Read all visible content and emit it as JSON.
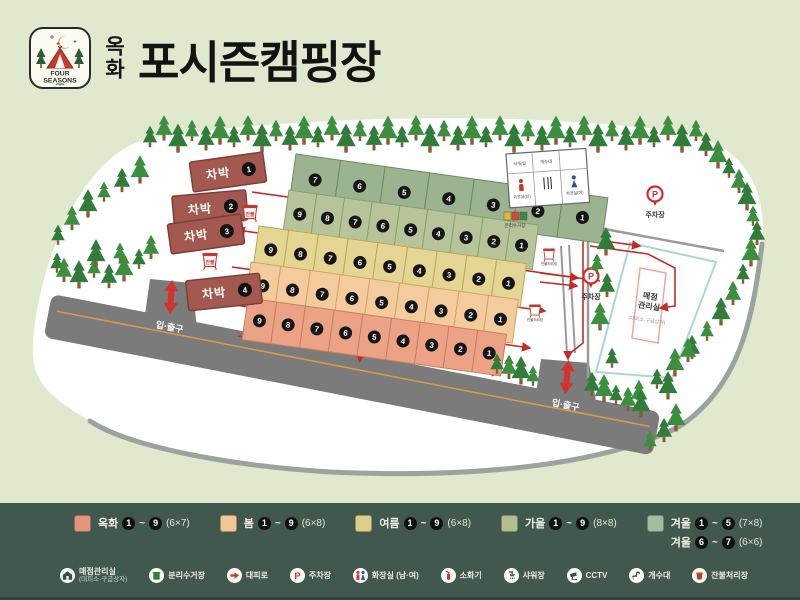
{
  "header": {
    "logo_line1": "FOUR",
    "logo_line2": "SEASONS",
    "brand_vertical": "옥화",
    "title": "포시즌캠핑장"
  },
  "map": {
    "entrance_label": "입·출구",
    "parking_label": "주차장",
    "store": {
      "name1": "매점",
      "name2": "관리실",
      "sub": "(대피소·구급상자)"
    },
    "recycle_label": "분리수거장",
    "ember_label": "잔불처리장",
    "ember_short": "잔불",
    "chabak": {
      "label": "차박",
      "sites": [
        1,
        2,
        3,
        4
      ]
    },
    "facility_rooms": [
      "샤워실",
      "개수대",
      "화장실(남)",
      "화장실(여)"
    ],
    "rows": [
      {
        "id": "winter",
        "name": "겨울",
        "numbers": [
          7,
          6,
          5,
          4,
          3,
          2,
          1
        ],
        "fill": "#9cb391",
        "stroke": "#6d8a62"
      },
      {
        "id": "autumn",
        "name": "가을",
        "numbers": [
          9,
          8,
          7,
          6,
          5,
          4,
          3,
          2,
          1
        ],
        "fill": "#b7c49a",
        "stroke": "#8ba06b"
      },
      {
        "id": "summer",
        "name": "여름",
        "numbers": [
          9,
          8,
          7,
          6,
          5,
          4,
          3,
          2,
          1
        ],
        "fill": "#e4d692",
        "stroke": "#b9a95e"
      },
      {
        "id": "spring",
        "name": "봄",
        "numbers": [
          9,
          8,
          7,
          6,
          5,
          4,
          3,
          2,
          1
        ],
        "fill": "#f4cb9d",
        "stroke": "#d2a369"
      },
      {
        "id": "okhwa",
        "name": "옥화",
        "numbers": [
          9,
          8,
          7,
          6,
          5,
          4,
          3,
          2,
          1
        ],
        "fill": "#eba285",
        "stroke": "#c97f5f"
      }
    ]
  },
  "legend": {
    "seasons": [
      {
        "name": "옥화",
        "from": "1",
        "to": "9",
        "size": "(6×7)",
        "color": "#e3957c"
      },
      {
        "name": "봄",
        "from": "1",
        "to": "9",
        "size": "(6×8)",
        "color": "#f0c897"
      },
      {
        "name": "여름",
        "from": "1",
        "to": "9",
        "size": "(6×8)",
        "color": "#ddcf8a"
      },
      {
        "name": "가을",
        "from": "1",
        "to": "9",
        "size": "(8×8)",
        "color": "#b2bf92"
      },
      {
        "name": "겨울",
        "from": "1",
        "to": "5",
        "size": "(7×8)",
        "color": "#a2bc9d",
        "line2": {
          "name": "겨울",
          "from": "6",
          "to": "7",
          "size": "(6×6)"
        }
      }
    ],
    "facilities": [
      {
        "icon": "store",
        "label": "매점관리실",
        "sub": "(대피소·구급상자)"
      },
      {
        "icon": "recycle",
        "label": "분리수거장"
      },
      {
        "icon": "route",
        "label": "대피로"
      },
      {
        "icon": "parking",
        "label": "주차장"
      },
      {
        "icon": "toilet",
        "label": "화장실 (남·여)"
      },
      {
        "icon": "extinguisher",
        "label": "소화기"
      },
      {
        "icon": "shower",
        "label": "샤워장"
      },
      {
        "icon": "cctv",
        "label": "CCTV"
      },
      {
        "icon": "sink",
        "label": "개수대"
      },
      {
        "icon": "ember",
        "label": "잔불처리장"
      }
    ]
  }
}
